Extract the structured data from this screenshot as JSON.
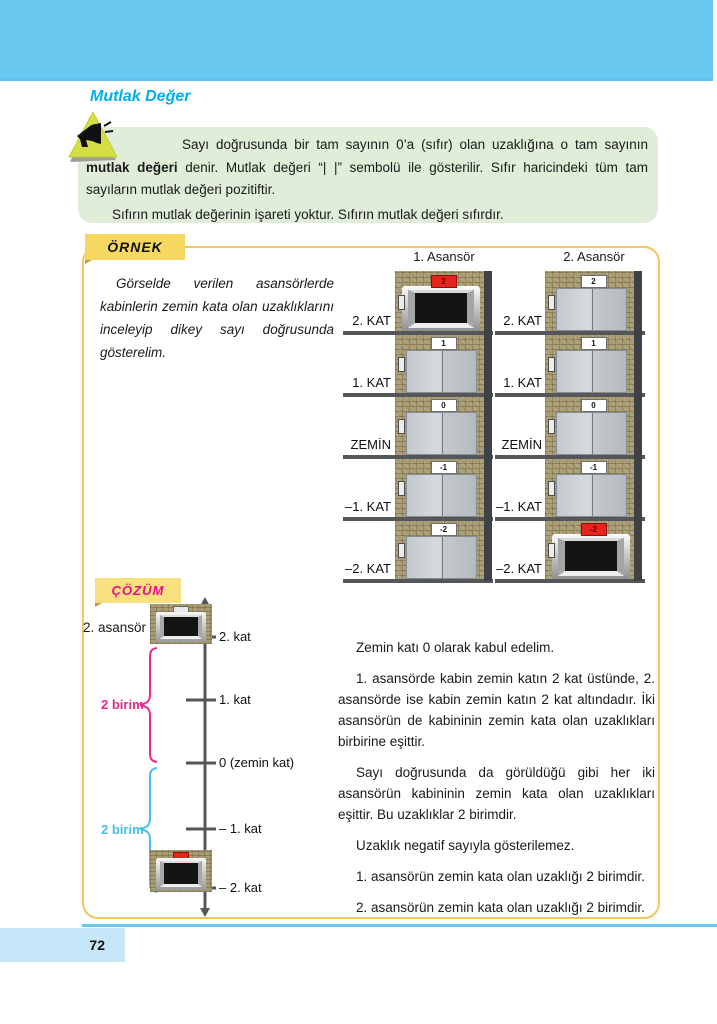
{
  "page": {
    "title": "Mutlak Değer",
    "page_number": "72"
  },
  "colors": {
    "header_band": "#68C8F0",
    "title_blue": "#00AEEF",
    "info_box_bg": "#DFEDD9",
    "example_border": "#F5C45C",
    "tag_yellow": "#F6D75F",
    "cozum_pink": "#EA0D8C",
    "brace_pink": "#EC268F",
    "brace_blue": "#45BEE8",
    "active_indicator_red": "#E8231A"
  },
  "info_box": {
    "p1a": "Sayı doğrusunda bir tam sayının 0’a (sıfır) olan uzaklığına o tam sayının ",
    "p1_bold": "mutlak değeri",
    "p1b": " denir. Mutlak değeri “| |” sembolü ile gösterilir. Sıfır haricindeki tüm tam sayıların mutlak değeri pozitiftir.",
    "p2": "Sıfırın mutlak değerinin işareti yoktur. Sıfırın mutlak değeri sıfırdır."
  },
  "example": {
    "label": "ÖRNEK",
    "question": "Görselde verilen asansörlerde kabinlerin zemin kata olan uzaklıklarını inceleyip dikey sayı doğrusunda gösterelim.",
    "floor_labels": [
      "2. KAT",
      "1. KAT",
      "ZEMİN",
      "–1. KAT",
      "–2. KAT"
    ],
    "elevator1": {
      "title": "1. Asansör",
      "indicators": [
        "2",
        "1",
        "0",
        "-1",
        "-2"
      ],
      "active_floor": "2"
    },
    "elevator2": {
      "title": "2. Asansör",
      "indicators": [
        "2",
        "1",
        "0",
        "-1",
        "-2"
      ],
      "active_floor": "-2"
    }
  },
  "solution": {
    "label": "ÇÖZÜM",
    "number_line": {
      "elevator_label": "2. asansör",
      "ticks": [
        "2. kat",
        "1. kat",
        "0 (zemin kat)",
        "– 1. kat",
        "– 2. kat"
      ],
      "brace_top_label": "2 birim",
      "brace_bottom_label": "2 birim"
    },
    "paragraphs": {
      "p1": "Zemin katı 0 olarak kabul edelim.",
      "p2": "1. asansörde kabin zemin katın 2 kat üstünde, 2. asansörde ise kabin zemin katın 2 kat altındadır. İki asansörün de kabininin zemin kata olan uzaklıkları birbirine eşittir.",
      "p3": "Sayı doğrusunda da görüldüğü gibi her iki asansörün kabininin zemin kata olan uzaklıkları eşittir. Bu uzaklıklar 2 birimdir.",
      "p4": "Uzaklık negatif sayıyla gösterilemez.",
      "p5": "1. asansörün zemin kata olan uzaklığı 2 birimdir.",
      "p6": "2. asansörün zemin kata olan uzaklığı 2 birimdir."
    }
  }
}
